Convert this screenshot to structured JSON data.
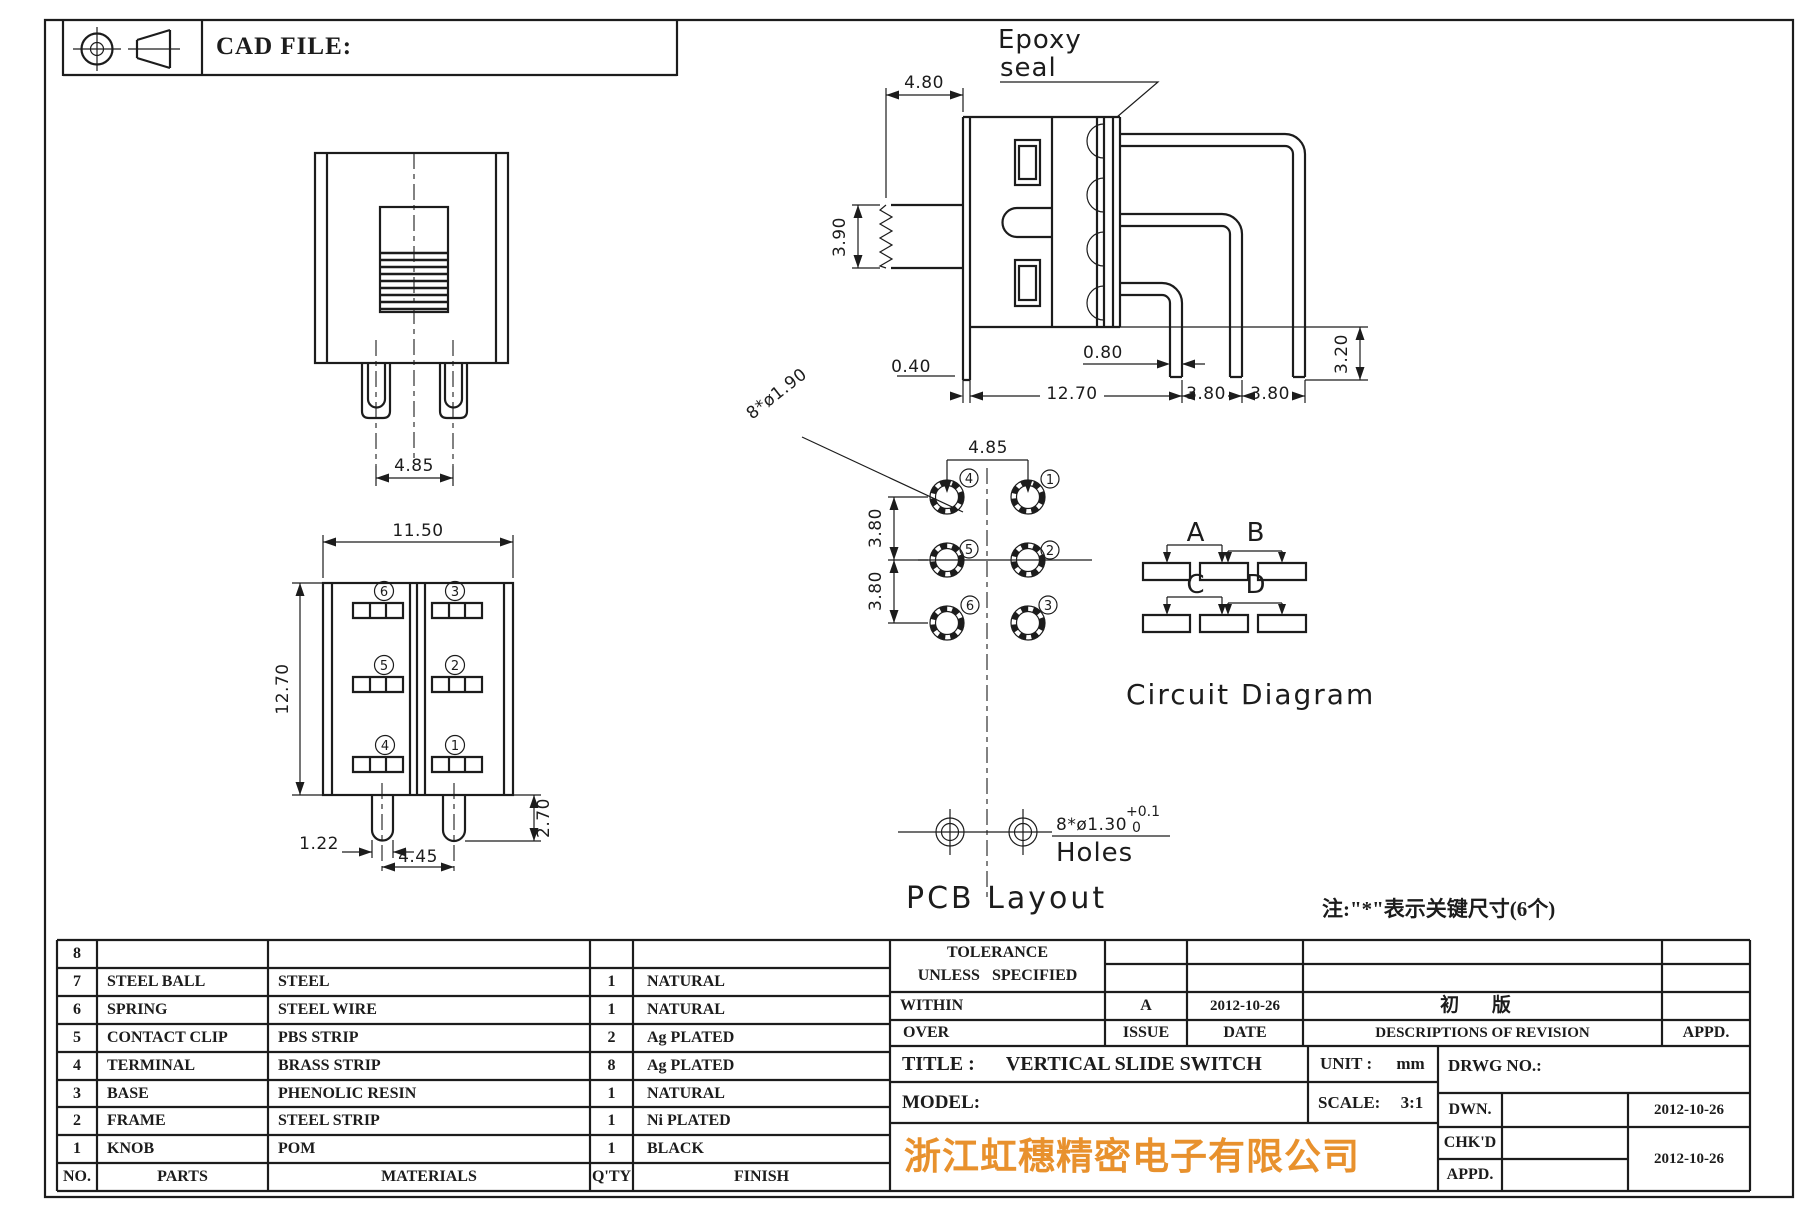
{
  "header": {
    "cad_file_label": "CAD FILE:"
  },
  "front_view": {
    "dim_pin_spacing": "4.85"
  },
  "bottom_view": {
    "dim_width": "11.50",
    "dim_height": "12.70",
    "dim_pin_width": "1.22",
    "dim_pin_spacing": "4.45",
    "dim_pin_length": "2.70",
    "terminal_numbers": [
      "6",
      "3",
      "5",
      "2",
      "4",
      "1"
    ]
  },
  "side_view": {
    "epoxy_label_line1": "Epoxy",
    "epoxy_label_line2": "seal",
    "dim_knob_width": "4.80",
    "dim_knob_height": "3.90",
    "dim_terminal_width": "0.80",
    "dim_frame_tab": "0.40",
    "dim_body_to_pin": "12.70",
    "dim_pin_pitch_1": "3.80",
    "dim_pin_pitch_2": "3.80",
    "dim_pin_length": "3.20"
  },
  "pcb_layout": {
    "title": "PCB Layout",
    "dim_hole_callout": "8*ø1.90",
    "dim_col_spacing": "4.85",
    "dim_row_spacing_1": "3.80",
    "dim_row_spacing_2": "3.80",
    "hole_numbers": [
      "4",
      "1",
      "5",
      "2",
      "6",
      "3"
    ],
    "mount_hole_callout": "8*ø1.30",
    "mount_hole_tol_upper": "+0.1",
    "mount_hole_tol_lower": "0",
    "mount_hole_label": "Holes"
  },
  "circuit_diagram": {
    "title": "Circuit Diagram",
    "group_labels": [
      "A",
      "B",
      "C",
      "D"
    ]
  },
  "note": "注:\"*\"表示关键尺寸(6个)",
  "parts_table": {
    "headers": {
      "no": "NO.",
      "parts": "PARTS",
      "materials": "MATERIALS",
      "qty": "Q'TY",
      "finish": "FINISH"
    },
    "rows": [
      {
        "no": "8",
        "parts": "",
        "materials": "",
        "qty": "",
        "finish": ""
      },
      {
        "no": "7",
        "parts": "STEEL BALL",
        "materials": "STEEL",
        "qty": "1",
        "finish": "NATURAL"
      },
      {
        "no": "6",
        "parts": "SPRING",
        "materials": "STEEL WIRE",
        "qty": "1",
        "finish": "NATURAL"
      },
      {
        "no": "5",
        "parts": "CONTACT CLIP",
        "materials": "PBS STRIP",
        "qty": "2",
        "finish": "Ag PLATED"
      },
      {
        "no": "4",
        "parts": "TERMINAL",
        "materials": "BRASS STRIP",
        "qty": "8",
        "finish": "Ag PLATED"
      },
      {
        "no": "3",
        "parts": "BASE",
        "materials": "PHENOLIC RESIN",
        "qty": "1",
        "finish": "NATURAL"
      },
      {
        "no": "2",
        "parts": "FRAME",
        "materials": "STEEL STRIP",
        "qty": "1",
        "finish": "Ni PLATED"
      },
      {
        "no": "1",
        "parts": "KNOB",
        "materials": "POM",
        "qty": "1",
        "finish": "BLACK"
      }
    ]
  },
  "tolerance_block": {
    "line1": "TOLERANCE",
    "line2": "UNLESS SPECIFIED",
    "within_label": "WITHIN",
    "over_label": "OVER"
  },
  "revision_block": {
    "issue_value": "A",
    "date_value": "2012-10-26",
    "description_value": "初 版",
    "issue_label": "ISSUE",
    "date_label": "DATE",
    "description_label": "DESCRIPTIONS OF REVISION",
    "appd_label": "APPD."
  },
  "title_block": {
    "title_label": "TITLE :",
    "title_value": "VERTICAL SLIDE SWITCH",
    "model_label": "MODEL:",
    "unit_label": "UNIT :",
    "unit_value": "mm",
    "scale_label": "SCALE:",
    "scale_value": "3:1",
    "drwg_no_label": "DRWG NO.:",
    "dwn_label": "DWN.",
    "chkd_label": "CHK'D",
    "appd_label": "APPD.",
    "dwn_date": "2012-10-26",
    "chk_appd_date": "2012-10-26",
    "company": "浙江虹穗精密电子有限公司",
    "company_color": "#e8912d"
  }
}
